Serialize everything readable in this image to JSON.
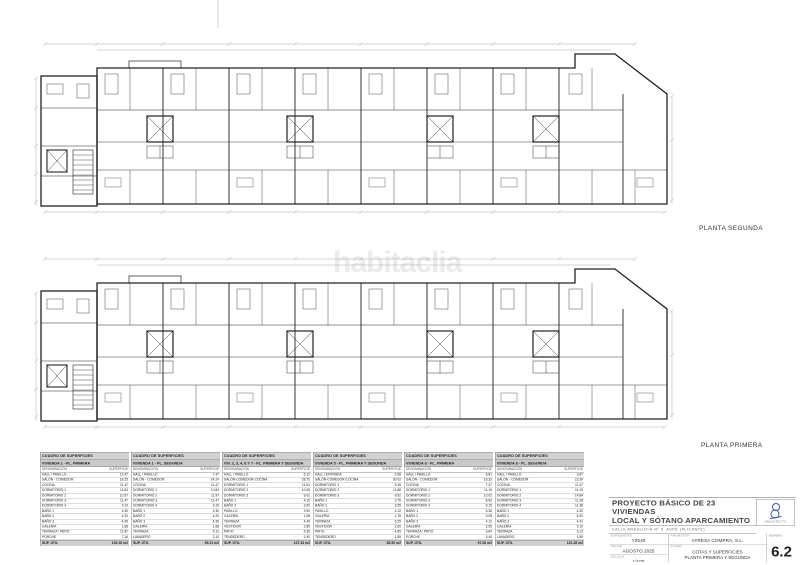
{
  "watermark": "habitaclia",
  "plan_labels": {
    "second": "PLANTA SEGUNDA",
    "first": "PLANTA PRIMERA"
  },
  "table_labels": {
    "den": "DENOMINACIÓN",
    "sup": "SUPERFICIE"
  },
  "tables": [
    {
      "title": "CUADRO DE SUPERFICIES",
      "subtitle": "VIVIENDA 1 - PL. PRIMERA",
      "rows": [
        [
          "HALL / PASILLO",
          "12.47"
        ],
        [
          "SALÓN - COMEDOR",
          "18.25"
        ],
        [
          "COCINA",
          "11.47"
        ],
        [
          "DORMITORIO 1",
          "11.84"
        ],
        [
          "DORMITORIO 2",
          "10.97"
        ],
        [
          "DORMITORIO 3",
          "11.47"
        ],
        [
          "DORMITORIO 4",
          "9.10"
        ],
        [
          "BAÑO 1",
          "4.30"
        ],
        [
          "BAÑO 2",
          "4.20"
        ],
        [
          "BAÑO 3",
          "4.35"
        ],
        [
          "GALERÍA",
          "1.68"
        ],
        [
          "TERRAZA / PATIO",
          "11.87"
        ],
        [
          "PORCHE",
          "7.16"
        ]
      ],
      "util_label": "SUP. ÚTIL",
      "util_value": "105.18 m2",
      "cons_label": "SUP. CONS (con P.P. zonas comunes)",
      "cons_value": "174.92 m2"
    },
    {
      "title": "CUADRO DE SUPERFICIES",
      "subtitle": "VIVIENDA 1 - PL. SEGUNDA",
      "rows": [
        [
          "HALL / PASILLO",
          "7.47"
        ],
        [
          "SALÓN - COMEDOR",
          "24.24"
        ],
        [
          "COCINA",
          "11.47"
        ],
        [
          "DORMITORIO 1",
          "10.84"
        ],
        [
          "DORMITORIO 2",
          "11.97"
        ],
        [
          "DORMITORIO 3",
          "11.47"
        ],
        [
          "DORMITORIO 4",
          "9.15"
        ],
        [
          "BAÑO 1",
          "4.30"
        ],
        [
          "BAÑO 2",
          "4.20"
        ],
        [
          "BAÑO 3",
          "4.35"
        ],
        [
          "GALERÍA",
          "1.68"
        ],
        [
          "TERRAZA",
          "5.12"
        ],
        [
          "LAVADERO",
          "2.10"
        ]
      ],
      "util_label": "SUP. ÚTIL",
      "util_value": "99.21 m2",
      "cons_label": "SUP. CONS (con P.P. zonas comunes)",
      "cons_value": "164.38 m2"
    },
    {
      "title": "CUADRO DE SUPERFICIES",
      "subtitle": "VIV. 2, 3, 4, 6 Y 7 - PL. PRIMERA Y SEGUNDA",
      "rows": [
        [
          "HALL / PASILLO",
          "6.12"
        ],
        [
          "SALÓN-COMEDOR-COCINA",
          "28.75"
        ],
        [
          "DORMITORIO 1",
          "11.61"
        ],
        [
          "DORMITORIO 2",
          "10.05"
        ],
        [
          "DORMITORIO 3",
          "9.02"
        ],
        [
          "BAÑO 1",
          "4.15"
        ],
        [
          "BAÑO 2",
          "3.60"
        ],
        [
          "PASILLO",
          "3.90"
        ],
        [
          "GALERÍA",
          "1.98"
        ],
        [
          "TERRAZA",
          "4.45"
        ],
        [
          "VESTIDOR",
          "2.85"
        ],
        [
          "PATIO",
          "5.30"
        ],
        [
          "TENDEDERO",
          "1.90"
        ]
      ],
      "util_label": "SUP. ÚTIL",
      "util_value": "107.43 m2",
      "cons_label": "SUP. CONS (con P.P. zonas comunes)",
      "cons_value": "138.46 m2"
    },
    {
      "title": "CUADRO DE SUPERFICIES",
      "subtitle": "VIVIENDA 5 - PL. PRIMERA Y SEGUNDA",
      "rows": [
        [
          "HALL / ENTRADA",
          "3.58"
        ],
        [
          "SALÓN-COMEDOR-COCINA",
          "30.02"
        ],
        [
          "DORMITORIO 1",
          "9.45"
        ],
        [
          "DORMITORIO 2",
          "11.68"
        ],
        [
          "DORMITORIO 3",
          "9.92"
        ],
        [
          "BAÑO 1",
          "3.75"
        ],
        [
          "BAÑO 2",
          "3.95"
        ],
        [
          "PASILLO",
          "4.12"
        ],
        [
          "GALERÍA",
          "1.78"
        ],
        [
          "TERRAZA",
          "5.25"
        ],
        [
          "VESTIDOR",
          "2.60"
        ],
        [
          "PATIO",
          "4.85"
        ],
        [
          "TENDEDERO",
          "1.85"
        ]
      ],
      "util_label": "SUP. ÚTIL",
      "util_value": "83.50 m2",
      "cons_label": "SUP. CONS (con P.P. zonas comunes)",
      "cons_value": "139.43 m2"
    },
    {
      "title": "CUADRO DE SUPERFICIES",
      "subtitle": "VIVIENDA 8 - PL. PRIMERA",
      "rows": [
        [
          "HALL / PASILLO",
          "6.81"
        ],
        [
          "SALÓN - COMEDOR",
          "19.33"
        ],
        [
          "COCINA",
          "7.47"
        ],
        [
          "DORMITORIO 1",
          "11.19"
        ],
        [
          "DORMITORIO 2",
          "10.02"
        ],
        [
          "DORMITORIO 3",
          "8.92"
        ],
        [
          "DORMITORIO 4",
          "9.15"
        ],
        [
          "BAÑO 1",
          "5.28"
        ],
        [
          "BAÑO 2",
          "3.08"
        ],
        [
          "BAÑO 3",
          "4.12"
        ],
        [
          "GALERÍA",
          "2.05"
        ],
        [
          "TERRAZA / PATIO",
          "9.64"
        ],
        [
          "PORCHE",
          "3.40"
        ]
      ],
      "util_label": "SUP. ÚTIL",
      "util_value": "97.06 m2",
      "cons_label": "SUP. CONS (con P.P. zonas comunes)",
      "cons_value": "160.71 m2"
    },
    {
      "title": "CUADRO DE SUPERFICIES",
      "subtitle": "VIVIENDA 8 - PL. SEGUNDA",
      "rows": [
        [
          "HALL / PASILLO",
          "3.87"
        ],
        [
          "SALÓN - COMEDOR",
          "23.30"
        ],
        [
          "COCINA",
          "11.47"
        ],
        [
          "DORMITORIO 1",
          "11.19"
        ],
        [
          "DORMITORIO 2",
          "14.84"
        ],
        [
          "DORMITORIO 3",
          "11.28"
        ],
        [
          "DORMITORIO 4",
          "11.38"
        ],
        [
          "BAÑO 1",
          "4.30"
        ],
        [
          "BAÑO 2",
          "5.20"
        ],
        [
          "BAÑO 3",
          "4.41"
        ],
        [
          "GALERÍA",
          "2.10"
        ],
        [
          "TERRAZA",
          "3.12"
        ],
        [
          "LAVADERO",
          "1.95"
        ]
      ],
      "util_label": "SUP. ÚTIL",
      "util_value": "121.28 m2",
      "cons_label": "SUP. CONS (con P.P. zonas comunes)",
      "cons_value": "199.82 m2"
    }
  ],
  "titleblock": {
    "title_line1": "PROYECTO BÁSICO DE 23 VIVIENDAS",
    "title_line2": "LOCAL Y SÓTANO APARCAMIENTO",
    "address": "CALLE ANDALUCÍA Nº 5. ASPE (ALICANTE)",
    "architect_caption": "ARQUITECTO",
    "expediente_label": "EXPEDIENTE",
    "expediente": "Y2540",
    "fecha_label": "FECHA",
    "fecha": "AGOSTO 2025",
    "escala_label": "ESCALA",
    "escala": "1/100",
    "promotor_label": "PROMOTOR",
    "promotor": "ATRESA COMPRA, S.L.",
    "plano_label": "PLANO",
    "plano_line1": "COTAS Y SUPERFICIES",
    "plano_line2": "PLANTA PRIMERA Y SEGUNDA",
    "numero_label": "NÚMERO",
    "numero": "6.2",
    "accent_color": "#3a5ca8"
  }
}
